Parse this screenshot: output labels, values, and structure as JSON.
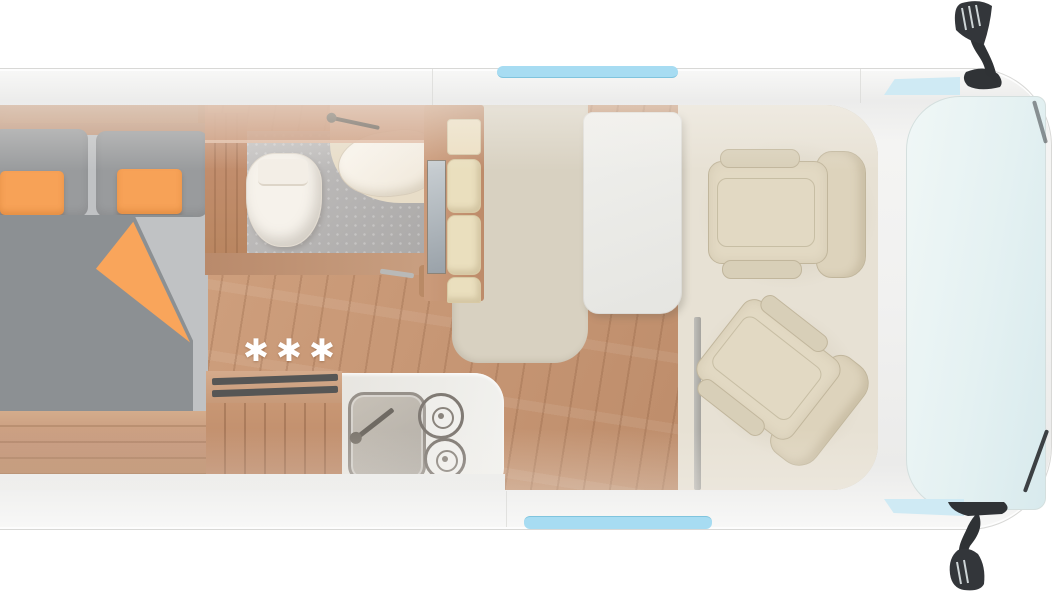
{
  "scene": {
    "label": "Camper van floor plan, top-down cutaway view",
    "floor_marks": "✱✱✱"
  },
  "colors": {
    "background": "#ffffff",
    "body": "#f1f1f0",
    "body_edge": "#d8d8d6",
    "window_glass": "#a7dcf2",
    "glass_light": "#cfeaf4",
    "windshield_a": "#f0f7f6",
    "windshield_b": "#d8eaed",
    "mirror_dark": "#33363a",
    "interior": "#e6e0d3",
    "mat": "#d8d1c1",
    "wood_floor": "#c89876",
    "wood_mid": "#c59478",
    "bench": "#c49579",
    "shower_gray": "#b3b1b0",
    "porcelain": "#f6f2eb",
    "basin_cream": "#f5efe4",
    "shelf": "#eadfbe",
    "bed_dark": "#8c9093",
    "bed_light": "#c0c2c4",
    "pillow_dark": "#999b9d",
    "orange": "#f7a257",
    "seat": "#ddd3bc",
    "seat_line": "#c1b69c",
    "table": "#ececea",
    "steel": "#97918a",
    "stripe_dark": "#565655"
  },
  "furniture": {
    "bed": "rear double bed with two orange pillows and orange throw",
    "bathroom": "wet room with toilet, corner basin and shower floor",
    "wardrobe": "shelved wardrobe with cream cushions",
    "kitchen": "kitchenette with sink, two-burner hob and wooden counter block",
    "table": "white dining table",
    "seat_passenger": "swivelled passenger cab seat",
    "seat_driver": "swivelled driver cab seat",
    "cab": "driver cab with windshield, side windows and two exterior mirrors"
  }
}
